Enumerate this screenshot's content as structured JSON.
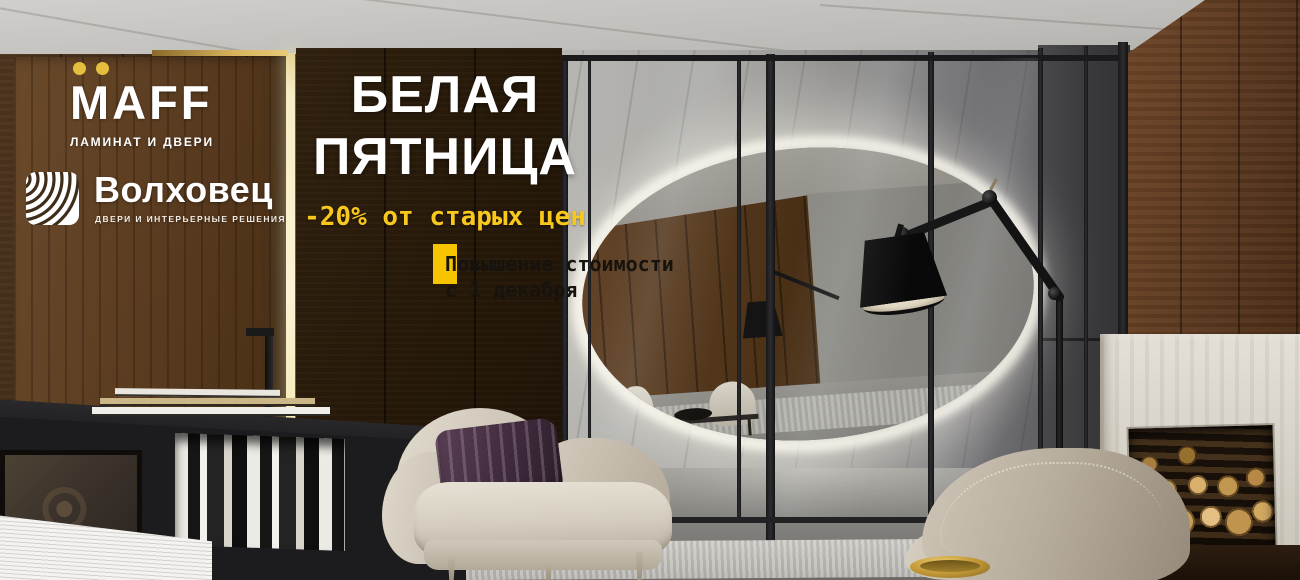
{
  "banner": {
    "width": 1300,
    "height": 580,
    "maff": {
      "name": "MAFF",
      "tagline": "ЛАМИНАТ И ДВЕРИ",
      "dots_color": "#E5BE3E",
      "text_color": "#FFFFFF"
    },
    "volkhovets": {
      "name": "Волховец",
      "tagline": "ДВЕРИ И ИНТЕРЬЕРНЫЕ РЕШЕНИЯ",
      "icon": "arc-rings-icon",
      "text_color": "#FFFFFF"
    },
    "promo": {
      "title_line1": "БЕЛАЯ",
      "title_line2": "ПЯТНИЦА",
      "discount": "-20% от старых цен",
      "notice_line1": "Повышение стоимости",
      "notice_line2": "с 1 декабря"
    },
    "colors": {
      "accent_yellow": "#F6C500",
      "discount_yellow": "#F9C81D",
      "title_white": "#FFFFFF",
      "notice_text": "#16130E"
    },
    "scene_elements": [
      "walnut-wall-panels",
      "hidden-door",
      "door-light-gap",
      "glass-partition",
      "round-backlit-mirror",
      "articulated-floor-lamp",
      "beige-armchair",
      "striped-pillow",
      "travertine-fireplace",
      "firewood-stack",
      "black-bookshelf",
      "area-rug",
      "brass-bowl",
      "concrete-ceiling",
      "stone-wall"
    ]
  }
}
